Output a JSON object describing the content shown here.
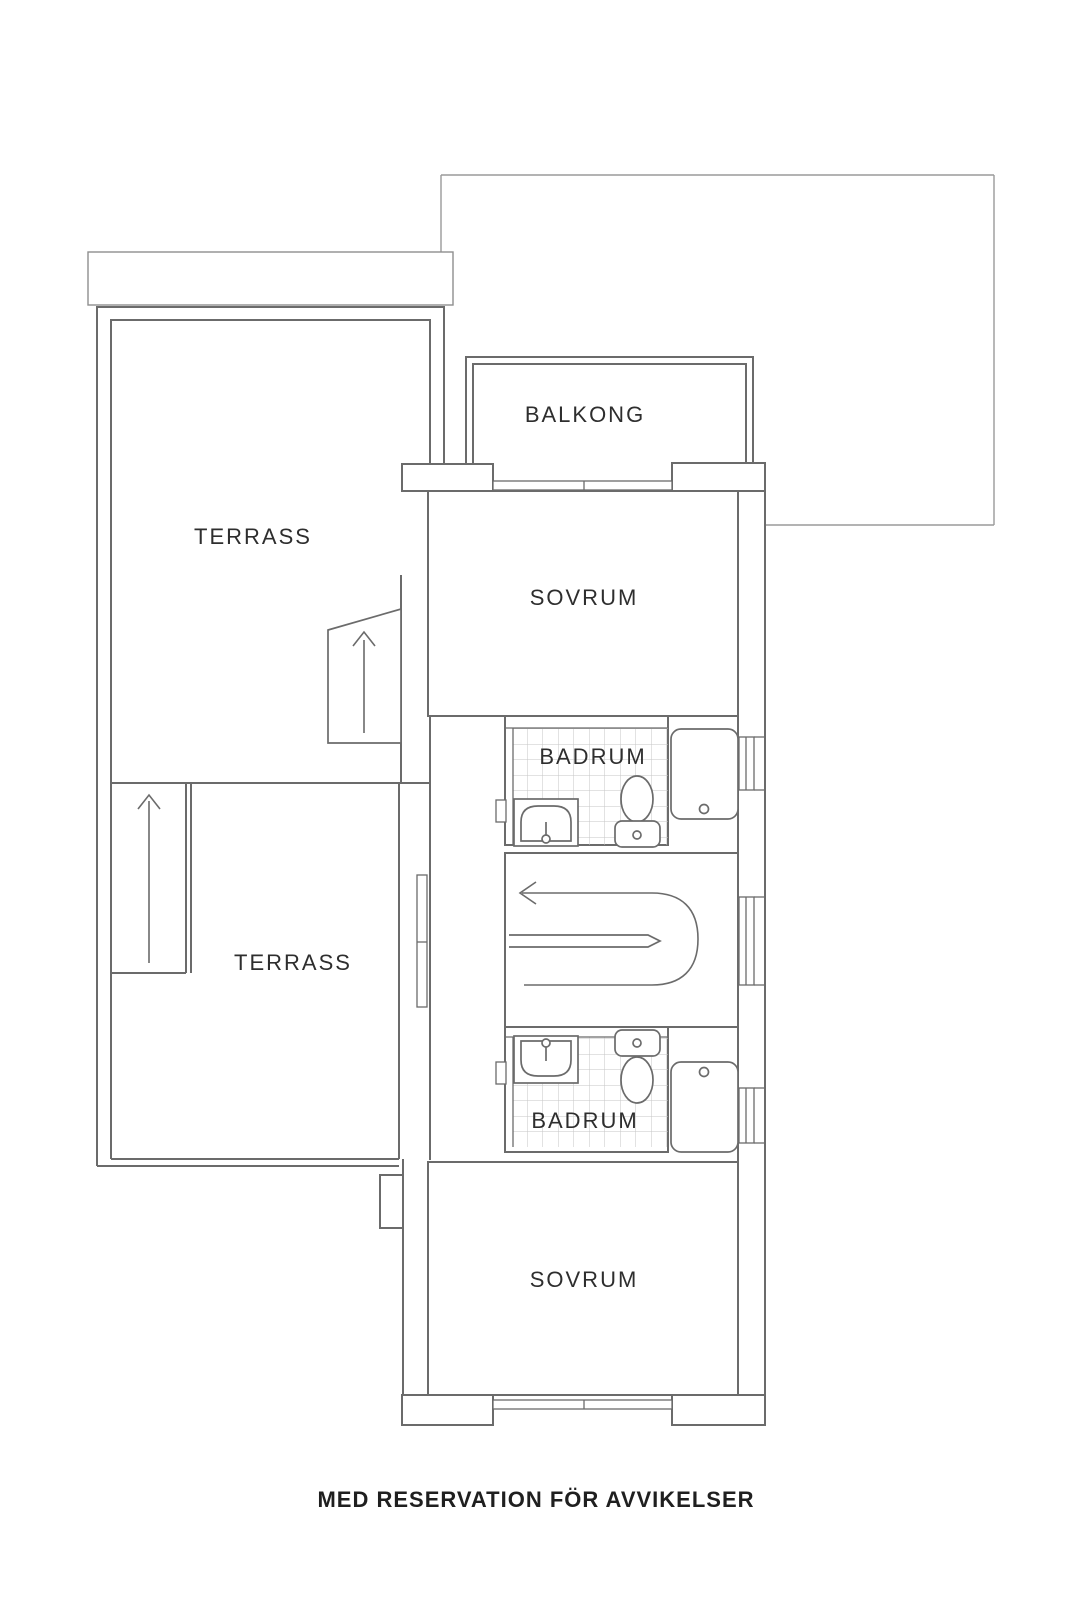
{
  "rooms": {
    "balkong": {
      "label": "BALKONG"
    },
    "terrass_upper": {
      "label": "TERRASS"
    },
    "terrass_lower": {
      "label": "TERRASS"
    },
    "sovrum_upper": {
      "label": "SOVRUM"
    },
    "sovrum_lower": {
      "label": "SOVRUM"
    },
    "badrum_upper": {
      "label": "BADRUM"
    },
    "badrum_lower": {
      "label": "BADRUM"
    }
  },
  "disclaimer": "MED RESERVATION FÖR AVVIKELSER",
  "icons": {
    "stairs_up_arrow": "↑",
    "stairs_direction_arrow": "←"
  },
  "colors": {
    "background": "#ffffff",
    "wall_line": "#6b6b6b",
    "thin_outline": "#9a9a9a",
    "tile_grid": "#c6c6c6",
    "label_text": "#2e2e2e"
  }
}
